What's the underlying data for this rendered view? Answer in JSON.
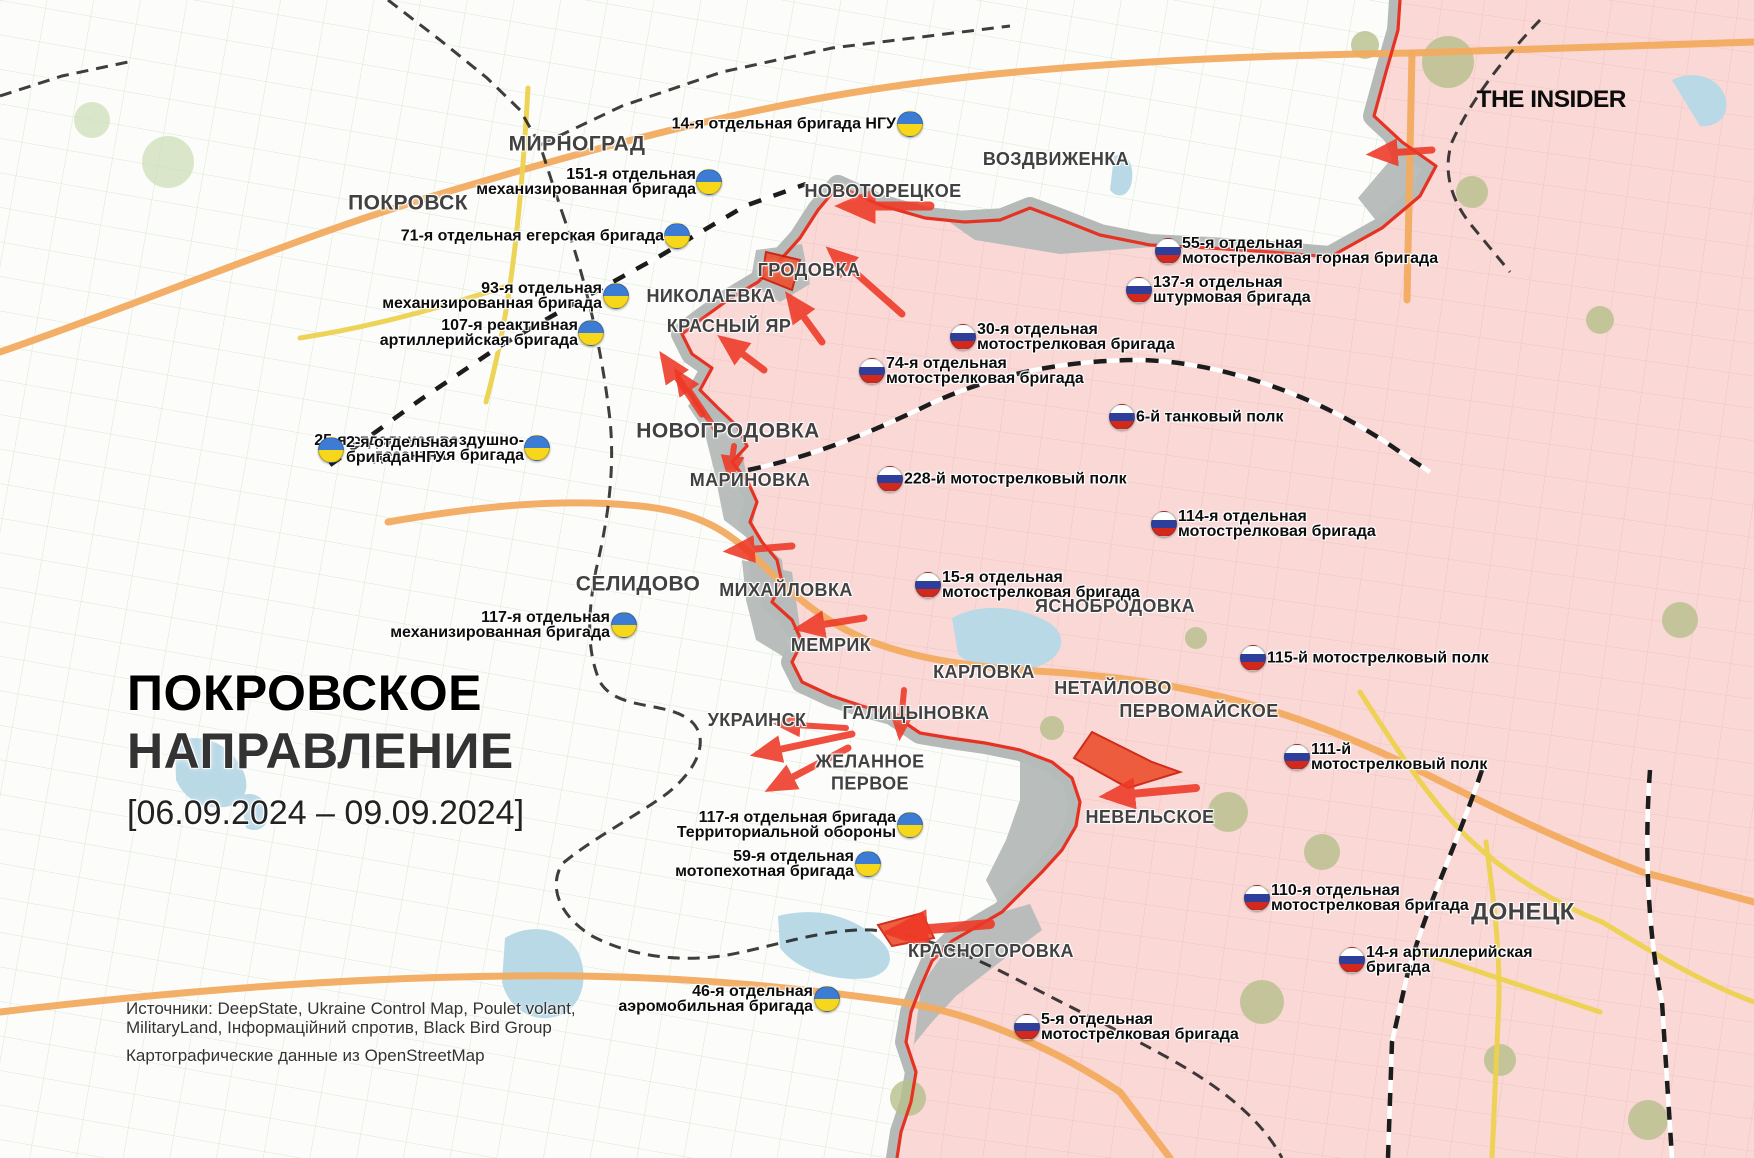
{
  "branding": {
    "logo_text": "THE INSIDER"
  },
  "title_block": {
    "line1": "ПОКРОВСКОЕ",
    "line2": "НАПРАВЛЕНИЕ",
    "date_range": "[06.09.2024 – 09.09.2024]"
  },
  "sources_block": {
    "line1": "Источники: DeepState, Ukraine Control Map, Poulet volant,",
    "line2": "MilitaryLand, Інформаційний спротив, Black Bird Group",
    "line3": "Картографические данные из OpenStreetMap"
  },
  "colors": {
    "title_red": "#ee3b27",
    "base_white": "#fcfdfa",
    "field_line_white": "#d6e5d0",
    "occupied_pink": "#f9d8d6",
    "field_line_pink": "#f0c2be",
    "gray_zone": "#b5bab8",
    "front_red": "#e63223",
    "arrow_red": "#ee3826",
    "wedge_fill": "#ed4f2e",
    "wedge_stroke": "#cc1a08",
    "road_orange": "#f2ab5f",
    "road_yellow": "#ecd24e",
    "rail_black": "#1c1c1c",
    "water_blue": "#b9d9e7",
    "forest_pink_area": "#b7bf8b",
    "forest_white_area": "#ccdcb4",
    "ua_flag_blue": "#3c7cd4",
    "ua_flag_yellow": "#f6d71c",
    "ru_flag_blue": "#2e3f9b",
    "ru_flag_red": "#d3291c"
  },
  "cities": [
    {
      "name": "МИРНОГРАД",
      "x": 577,
      "y": 144,
      "size": 21
    },
    {
      "name": "ПОКРОВСК",
      "x": 408,
      "y": 203,
      "size": 21
    },
    {
      "name": "ВОЗДВИЖЕНКА",
      "x": 1056,
      "y": 160,
      "size": 18
    },
    {
      "name": "НОВОТОРЕЦКОЕ",
      "x": 883,
      "y": 192,
      "size": 18
    },
    {
      "name": "ГРОДОВКА",
      "x": 809,
      "y": 271,
      "size": 18
    },
    {
      "name": "НИКОЛАЕВКА",
      "x": 711,
      "y": 297,
      "size": 18
    },
    {
      "name": "КРАСНЫЙ ЯР",
      "x": 729,
      "y": 327,
      "size": 18
    },
    {
      "name": "НОВОГРОДОВКА",
      "x": 728,
      "y": 431,
      "size": 21
    },
    {
      "name": "МАРИНОВКА",
      "x": 750,
      "y": 481,
      "size": 18
    },
    {
      "name": "СЕЛИДОВО",
      "x": 638,
      "y": 584,
      "size": 21
    },
    {
      "name": "МИХАЙЛОВКА",
      "x": 786,
      "y": 591,
      "size": 18
    },
    {
      "name": "ЯСНОБРОДОВКА",
      "x": 1115,
      "y": 607,
      "size": 18
    },
    {
      "name": "МЕМРИК",
      "x": 831,
      "y": 646,
      "size": 18
    },
    {
      "name": "КАРЛОВКА",
      "x": 984,
      "y": 673,
      "size": 18
    },
    {
      "name": "НЕТАЙЛОВО",
      "x": 1113,
      "y": 689,
      "size": 18
    },
    {
      "name": "ПЕРВОМАЙСКОЕ",
      "x": 1199,
      "y": 712,
      "size": 18
    },
    {
      "name": "УКРАИНСК",
      "x": 757,
      "y": 721,
      "size": 18
    },
    {
      "name": "ГАЛИЦЫНОВКА",
      "x": 916,
      "y": 714,
      "size": 18
    },
    {
      "name": "ЖЕЛАННОЕ\nПЕРВОЕ",
      "x": 870,
      "y": 773,
      "size": 18
    },
    {
      "name": "НЕВЕЛЬСКОЕ",
      "x": 1150,
      "y": 818,
      "size": 18
    },
    {
      "name": "КРАСНОГОРОВКА",
      "x": 991,
      "y": 952,
      "size": 18
    },
    {
      "name": "ДОНЕЦК",
      "x": 1523,
      "y": 913,
      "size": 24
    }
  ],
  "units": [
    {
      "side": "ua",
      "anchor": "right",
      "lines": [
        "14-я отдельная бригада НГУ"
      ],
      "flag_x": 910,
      "flag_y": 124,
      "text_x": 896,
      "text_y": 124
    },
    {
      "side": "ua",
      "anchor": "right",
      "lines": [
        "151-я отдельная",
        "механизированная бригада"
      ],
      "flag_x": 709,
      "flag_y": 182,
      "text_x": 696,
      "text_y": 182
    },
    {
      "side": "ua",
      "anchor": "right",
      "lines": [
        "71-я отдельная егерская бригада"
      ],
      "flag_x": 677,
      "flag_y": 236,
      "text_x": 664,
      "text_y": 236
    },
    {
      "side": "ua",
      "anchor": "right",
      "lines": [
        "93-я отдельная",
        "механизированная бригада"
      ],
      "flag_x": 616,
      "flag_y": 296,
      "text_x": 602,
      "text_y": 296
    },
    {
      "side": "ua",
      "anchor": "right",
      "lines": [
        "107-я реактивная",
        "артиллерийская бригада"
      ],
      "flag_x": 591,
      "flag_y": 333,
      "text_x": 578,
      "text_y": 333
    },
    {
      "side": "ua",
      "anchor": "right",
      "lines": [
        "25-я отдельная воздушно-",
        "десантная бригада"
      ],
      "flag_x": 537,
      "flag_y": 448,
      "text_x": 524,
      "text_y": 448
    },
    {
      "side": "ua",
      "anchor": "left",
      "lines": [
        "2-я отдельная",
        "бригада НГУ"
      ],
      "flag_x": 331,
      "flag_y": 450,
      "text_x": 346,
      "text_y": 450
    },
    {
      "side": "ua",
      "anchor": "right",
      "lines": [
        "117-я отдельная",
        "механизированная бригада"
      ],
      "flag_x": 624,
      "flag_y": 625,
      "text_x": 610,
      "text_y": 625
    },
    {
      "side": "ua",
      "anchor": "right",
      "lines": [
        "117-я отдельная бригада",
        "Территориальной обороны"
      ],
      "flag_x": 910,
      "flag_y": 825,
      "text_x": 896,
      "text_y": 825
    },
    {
      "side": "ua",
      "anchor": "right",
      "lines": [
        "59-я отдельная",
        "мотопехотная бригада"
      ],
      "flag_x": 868,
      "flag_y": 864,
      "text_x": 854,
      "text_y": 864
    },
    {
      "side": "ua",
      "anchor": "right",
      "lines": [
        "46-я отдельная",
        "аэромобильная бригада"
      ],
      "flag_x": 827,
      "flag_y": 999,
      "text_x": 813,
      "text_y": 999
    },
    {
      "side": "ru",
      "anchor": "left",
      "lines": [
        "55-я отдельная",
        "мотострелковая горная бригада"
      ],
      "flag_x": 1168,
      "flag_y": 251,
      "text_x": 1182,
      "text_y": 251
    },
    {
      "side": "ru",
      "anchor": "left",
      "lines": [
        "137-я отдельная",
        "штурмовая бригада"
      ],
      "flag_x": 1139,
      "flag_y": 290,
      "text_x": 1153,
      "text_y": 290
    },
    {
      "side": "ru",
      "anchor": "left",
      "lines": [
        "30-я отдельная",
        "мотострелковая бригада"
      ],
      "flag_x": 963,
      "flag_y": 337,
      "text_x": 977,
      "text_y": 337
    },
    {
      "side": "ru",
      "anchor": "left",
      "lines": [
        "74-я отдельная",
        "мотострелковая бригада"
      ],
      "flag_x": 872,
      "flag_y": 371,
      "text_x": 886,
      "text_y": 371
    },
    {
      "side": "ru",
      "anchor": "left",
      "lines": [
        "6-й танковый полк"
      ],
      "flag_x": 1122,
      "flag_y": 417,
      "text_x": 1136,
      "text_y": 417
    },
    {
      "side": "ru",
      "anchor": "left",
      "lines": [
        "228-й мотострелковый полк"
      ],
      "flag_x": 890,
      "flag_y": 479,
      "text_x": 904,
      "text_y": 479
    },
    {
      "side": "ru",
      "anchor": "left",
      "lines": [
        "114-я отдельная",
        "мотострелковая бригада"
      ],
      "flag_x": 1164,
      "flag_y": 524,
      "text_x": 1178,
      "text_y": 524
    },
    {
      "side": "ru",
      "anchor": "left",
      "lines": [
        "15-я отдельная",
        "мотострелковая бригада"
      ],
      "flag_x": 928,
      "flag_y": 585,
      "text_x": 942,
      "text_y": 585
    },
    {
      "side": "ru",
      "anchor": "left",
      "lines": [
        "115-й мотострелковый полк"
      ],
      "flag_x": 1253,
      "flag_y": 658,
      "text_x": 1267,
      "text_y": 658
    },
    {
      "side": "ru",
      "anchor": "left",
      "lines": [
        "111-й",
        "мотострелковый полк"
      ],
      "flag_x": 1297,
      "flag_y": 757,
      "text_x": 1311,
      "text_y": 757
    },
    {
      "side": "ru",
      "anchor": "left",
      "lines": [
        "110-я отдельная",
        "мотострелковая бригада"
      ],
      "flag_x": 1257,
      "flag_y": 898,
      "text_x": 1271,
      "text_y": 898
    },
    {
      "side": "ru",
      "anchor": "left",
      "lines": [
        "14-я артиллерийская",
        "бригада"
      ],
      "flag_x": 1352,
      "flag_y": 960,
      "text_x": 1366,
      "text_y": 960
    },
    {
      "side": "ru",
      "anchor": "left",
      "lines": [
        "5-я отдельная",
        "мотострелковая бригада"
      ],
      "flag_x": 1027,
      "flag_y": 1027,
      "text_x": 1041,
      "text_y": 1027
    }
  ],
  "map_layers": {
    "front_north": [
      [
        838,
        186
      ],
      [
        880,
        205
      ],
      [
        925,
        218
      ],
      [
        965,
        222
      ],
      [
        1000,
        220
      ],
      [
        1030,
        208
      ],
      [
        1062,
        220
      ],
      [
        1100,
        235
      ],
      [
        1150,
        245
      ],
      [
        1210,
        248
      ],
      [
        1270,
        252
      ],
      [
        1330,
        257
      ],
      [
        1382,
        228
      ],
      [
        1420,
        196
      ],
      [
        1436,
        166
      ],
      [
        1402,
        142
      ],
      [
        1374,
        116
      ],
      [
        1386,
        72
      ],
      [
        1398,
        30
      ],
      [
        1400,
        0
      ]
    ],
    "front_west": [
      [
        838,
        186
      ],
      [
        818,
        210
      ],
      [
        800,
        238
      ],
      [
        782,
        258
      ],
      [
        758,
        282
      ],
      [
        728,
        300
      ],
      [
        703,
        318
      ],
      [
        682,
        334
      ],
      [
        692,
        354
      ],
      [
        712,
        368
      ],
      [
        700,
        390
      ],
      [
        718,
        408
      ],
      [
        737,
        426
      ],
      [
        747,
        446
      ],
      [
        732,
        462
      ],
      [
        748,
        482
      ],
      [
        757,
        502
      ],
      [
        750,
        522
      ],
      [
        762,
        542
      ],
      [
        777,
        560
      ],
      [
        782,
        582
      ],
      [
        772,
        602
      ],
      [
        792,
        620
      ],
      [
        802,
        642
      ],
      [
        792,
        662
      ],
      [
        802,
        682
      ],
      [
        832,
        696
      ],
      [
        862,
        706
      ],
      [
        892,
        714
      ],
      [
        920,
        733
      ],
      [
        950,
        738
      ],
      [
        985,
        743
      ],
      [
        1020,
        750
      ],
      [
        1052,
        762
      ],
      [
        1072,
        778
      ],
      [
        1080,
        802
      ],
      [
        1076,
        826
      ],
      [
        1062,
        850
      ],
      [
        1042,
        872
      ],
      [
        1022,
        892
      ],
      [
        1002,
        912
      ],
      [
        978,
        926
      ],
      [
        952,
        941
      ],
      [
        932,
        961
      ],
      [
        921,
        986
      ],
      [
        911,
        1012
      ],
      [
        906,
        1042
      ],
      [
        916,
        1072
      ],
      [
        911,
        1102
      ],
      [
        901,
        1132
      ],
      [
        897,
        1158
      ]
    ],
    "gray_patches": [
      "935,212 1040,206 1122,238 1152,247 1060,254 975,240",
      "742,560 792,572 802,642 792,662 756,640 746,600",
      "1020,750 1066,772 1080,802 1076,830 1058,854 1020,880 1000,906 986,880 1006,840 1020,800",
      "921,986 952,941 978,926 1002,912 1030,904 1042,930 1000,962 956,996 932,1022 914,1044",
      "756,250 802,244 810,284 780,302 750,284",
      "1374,116 1402,142 1436,166 1420,196 1382,228 1358,198 1392,158",
      "700,390 737,426 748,482 757,502 750,540 724,520 714,470 704,430 688,406",
      "762,542 782,560 786,600 772,612 752,586 748,560"
    ],
    "wedges": [
      "1092,732 1152,762 1180,772 1128,788 1074,758",
      "766,252 800,260 792,290 762,278",
      "878,925 922,913 934,938 892,946"
    ],
    "arrows": [
      {
        "x1": 1432,
        "y1": 150,
        "x2": 1374,
        "y2": 154,
        "w": 7
      },
      {
        "x1": 930,
        "y1": 206,
        "x2": 845,
        "y2": 206,
        "w": 9
      },
      {
        "x1": 902,
        "y1": 314,
        "x2": 832,
        "y2": 252,
        "w": 7
      },
      {
        "x1": 822,
        "y1": 342,
        "x2": 790,
        "y2": 298,
        "w": 7
      },
      {
        "x1": 764,
        "y1": 370,
        "x2": 724,
        "y2": 340,
        "w": 7
      },
      {
        "x1": 702,
        "y1": 414,
        "x2": 664,
        "y2": 358,
        "w": 7
      },
      {
        "x1": 716,
        "y1": 430,
        "x2": 678,
        "y2": 374,
        "w": 6
      },
      {
        "x1": 734,
        "y1": 446,
        "x2": 730,
        "y2": 476,
        "w": 6
      },
      {
        "x1": 792,
        "y1": 546,
        "x2": 731,
        "y2": 551,
        "w": 7
      },
      {
        "x1": 864,
        "y1": 618,
        "x2": 801,
        "y2": 628,
        "w": 7
      },
      {
        "x1": 904,
        "y1": 690,
        "x2": 900,
        "y2": 734,
        "w": 6
      },
      {
        "x1": 852,
        "y1": 734,
        "x2": 758,
        "y2": 754,
        "w": 7
      },
      {
        "x1": 848,
        "y1": 748,
        "x2": 772,
        "y2": 788,
        "w": 7
      },
      {
        "x1": 846,
        "y1": 728,
        "x2": 780,
        "y2": 724,
        "w": 6
      },
      {
        "x1": 1196,
        "y1": 788,
        "x2": 1108,
        "y2": 796,
        "w": 8
      },
      {
        "x1": 990,
        "y1": 924,
        "x2": 894,
        "y2": 932,
        "w": 10
      }
    ],
    "roads_orange": [
      "M 0,352 C 150,300 300,236 430,197 C 560,158 700,118 850,93 C 1000,68 1200,56 1412,53 L 1754,42",
      "M 1412,53 L 1407,300",
      "M 388,522 C 480,506 560,498 640,506 C 700,512 730,532 760,562 C 790,592 822,622 872,642 C 932,664 992,668 1052,672 C 1122,677 1182,686 1242,702 C 1302,718 1362,742 1422,772 C 1482,802 1562,842 1642,872 L 1754,902",
      "M 0,1012 C 200,988 400,974 580,976 C 700,978 800,988 900,1002 C 980,1014 1060,1052 1120,1092 L 1170,1158"
    ],
    "roads_yellow": [
      "M 528,88 C 524,160 518,230 510,285 C 503,335 494,372 486,402",
      "M 510,285 C 445,306 378,326 300,338",
      "M 1360,692 C 1392,742 1424,792 1462,832 C 1502,872 1552,902 1602,922",
      "M 1486,842 C 1494,902 1502,962 1498,1022 L 1492,1158",
      "M 1420,952 L 1600,1012",
      "M 1602,922 C 1652,952 1700,982 1754,1002"
    ],
    "rails": [
      {
        "d": "M 388,0 L 440,40 L 487,78 L 520,110 L 540,145 L 552,182 L 562,212",
        "style": "border"
      },
      {
        "d": "M 540,145 L 622,106 L 722,72 L 832,48 L 1010,26",
        "style": "border"
      },
      {
        "d": "M 330,465 L 420,400 L 500,346 L 580,300 L 660,256 L 745,206 L 806,184",
        "style": "rail"
      },
      {
        "d": "M 748,470 C 820,455 880,428 930,404 C 990,376 1060,360 1140,360 C 1230,362 1330,402 1400,452 L 1430,472",
        "style": "rail"
      },
      {
        "d": "M 1540,20 C 1500,62 1470,102 1452,142 C 1442,172 1452,202 1472,226 L 1510,272",
        "style": "border"
      },
      {
        "d": "M 1482,770 C 1458,842 1428,902 1408,972 L 1392,1042 L 1388,1158",
        "style": "rail"
      },
      {
        "d": "M 1650,770 C 1644,850 1648,932 1662,1002 L 1672,1158",
        "style": "rail"
      },
      {
        "d": "M 562,212 C 586,280 602,350 610,420 C 615,470 608,520 596,570 C 588,612 586,650 600,682 C 618,712 668,700 692,722 C 712,742 694,776 658,800 C 622,824 588,842 562,864 C 548,888 560,916 592,936 C 630,956 676,962 722,956 C 770,948 822,928 872,930 C 922,934 972,956 1022,982 C 1072,1008 1122,1032 1172,1060 C 1222,1088 1262,1120 1282,1158",
        "style": "border"
      },
      {
        "d": "M 0,96 L 62,76 L 128,62",
        "style": "border"
      }
    ],
    "water": [
      "M 175,742 C 200,732 225,742 238,762 C 252,782 248,800 230,806 C 205,812 185,800 176,780 Z",
      "M 240,796 C 254,790 266,798 268,812 C 270,826 258,834 246,828 Z",
      "M 505,938 C 530,922 565,928 578,952 C 590,978 582,1008 558,1016 C 532,1024 508,1008 502,982 Z",
      "M 952,618 C 980,602 1020,606 1048,622 C 1068,634 1064,654 1044,664 C 1014,678 976,672 958,654 Z",
      "M 1672,80 C 1692,70 1716,76 1724,94 C 1732,112 1720,128 1700,126 Z",
      "M 778,916 C 818,906 852,916 880,940 C 898,956 890,974 868,978 C 838,982 798,972 780,948 Z",
      "M 1114,156 C 1126,152 1134,162 1132,180 C 1130,196 1118,200 1110,190 Z"
    ],
    "forests_pink": [
      [
        1448,
        62,
        26
      ],
      [
        1472,
        192,
        16
      ],
      [
        1365,
        45,
        14
      ],
      [
        1228,
        812,
        20
      ],
      [
        1322,
        852,
        18
      ],
      [
        1262,
        1002,
        22
      ],
      [
        1052,
        728,
        12
      ],
      [
        1196,
        638,
        11
      ],
      [
        908,
        1098,
        18
      ],
      [
        1648,
        1120,
        20
      ],
      [
        1500,
        1060,
        16
      ],
      [
        1600,
        320,
        14
      ],
      [
        1680,
        620,
        18
      ]
    ],
    "forests_white": [
      [
        168,
        162,
        26
      ],
      [
        92,
        120,
        18
      ]
    ]
  }
}
